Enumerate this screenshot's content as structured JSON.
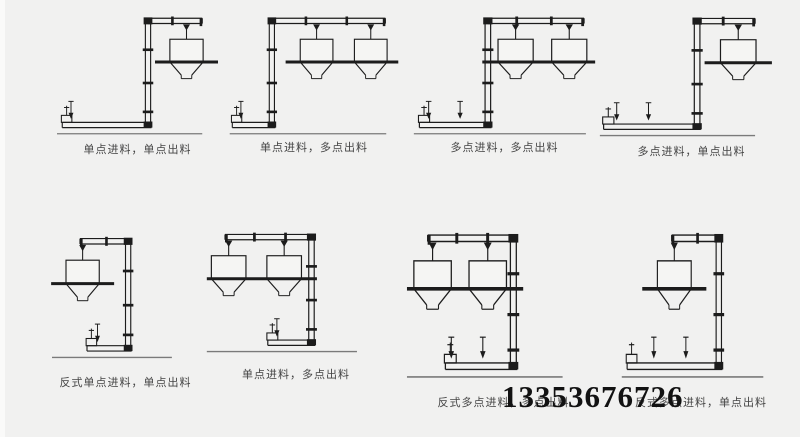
{
  "style": {
    "background": "#f1f1f0",
    "line_color": "#1c1c1c",
    "ground_color": "#7a7a7a",
    "hopper_fill": "#f5f5f3",
    "label_color": "#454545",
    "phone_color": "#121212"
  },
  "phone": {
    "number": "13353676726"
  },
  "figure": {
    "subject": "Z型斗式提升机配置图"
  },
  "diagrams": [
    {
      "label": "单点进料，单点出料",
      "orientation": "normal",
      "feed_points": 1,
      "hoppers": 1
    },
    {
      "label": "单点进料，多点出料",
      "orientation": "normal",
      "feed_points": 1,
      "hoppers": 2
    },
    {
      "label": "多点进料，多点出料",
      "orientation": "normal",
      "feed_points": 2,
      "hoppers": 2
    },
    {
      "label": "多点进料，单点出料",
      "orientation": "normal",
      "feed_points": 2,
      "hoppers": 1
    },
    {
      "label": "反式单点进料，单点出料",
      "orientation": "reverse",
      "feed_points": 1,
      "hoppers": 1
    },
    {
      "label": "单点进料，多点出料",
      "orientation": "reverse",
      "feed_points": 1,
      "hoppers": 2
    },
    {
      "label": "反式多点进料，多点出料",
      "orientation": "reverse",
      "feed_points": 2,
      "hoppers": 2
    },
    {
      "label": "反式多点进料，单点出料",
      "orientation": "reverse",
      "feed_points": 2,
      "hoppers": 1
    }
  ]
}
